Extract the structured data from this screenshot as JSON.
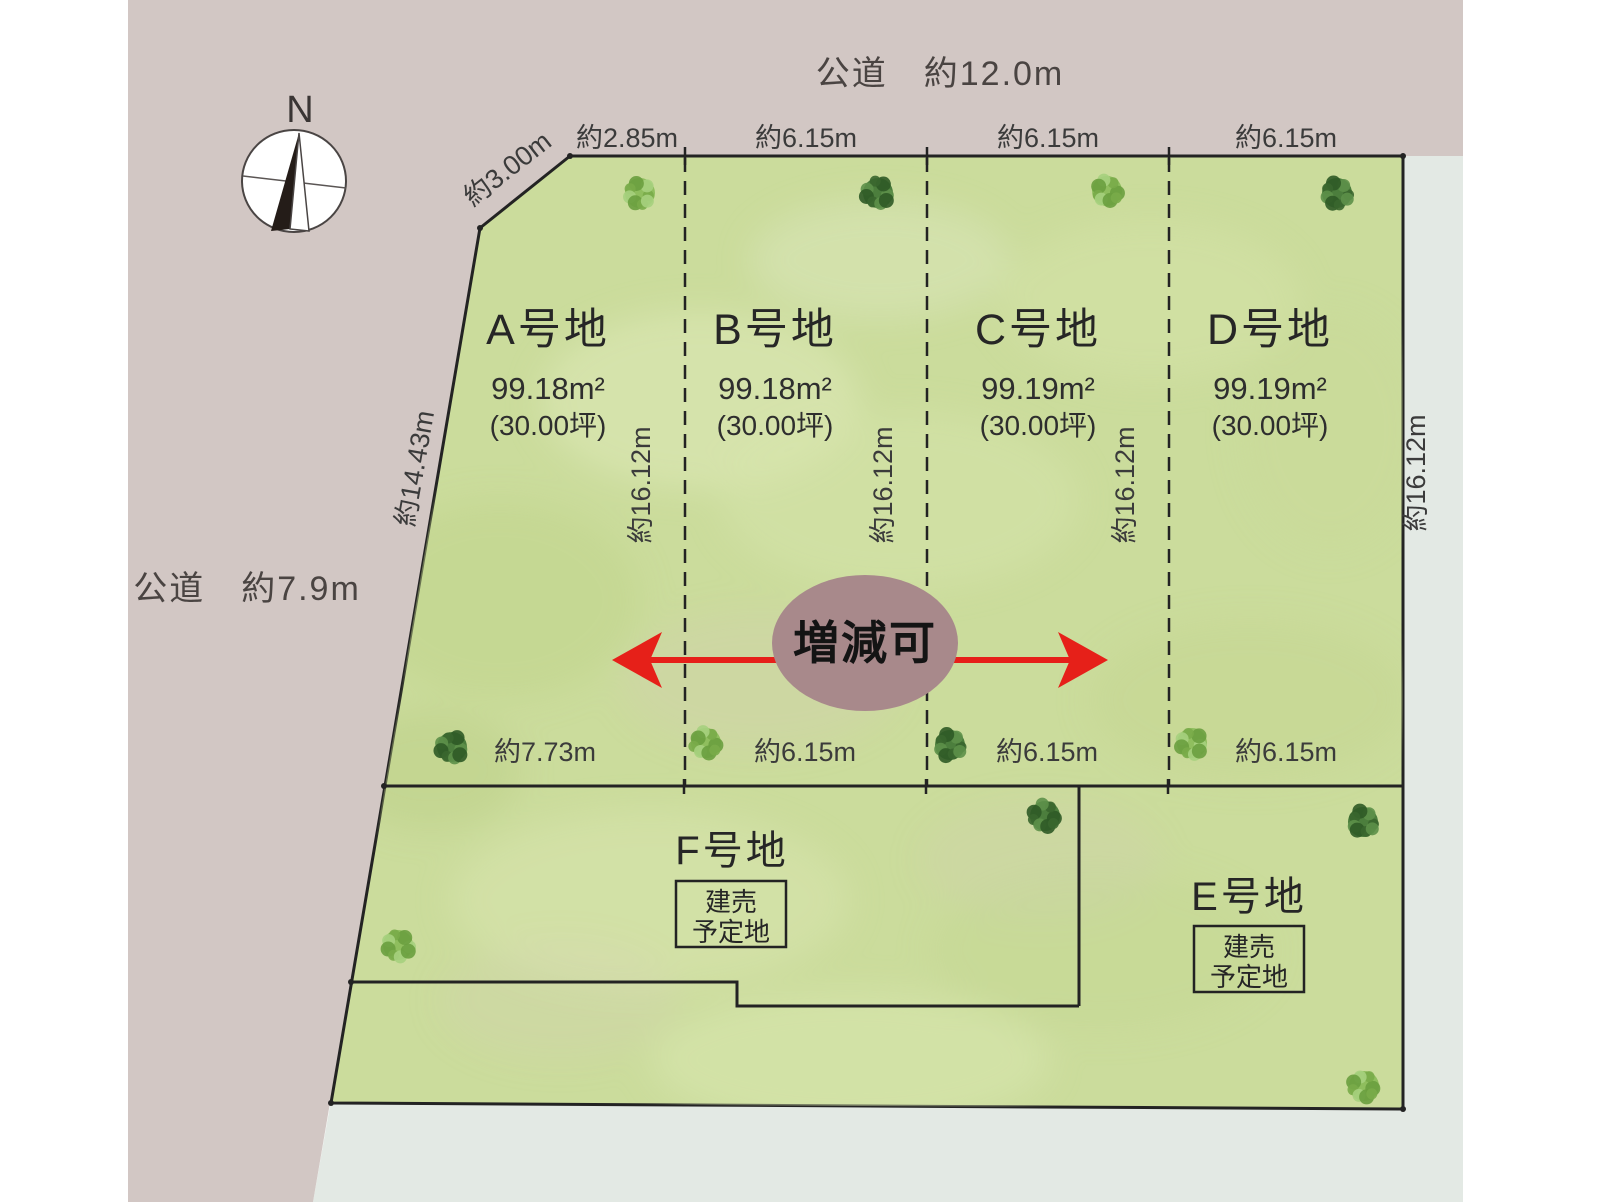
{
  "roads": {
    "top_label": "公道　約12.0m",
    "left_label": "公道　約7.9m"
  },
  "compass": {
    "north_label": "N"
  },
  "plots": {
    "a": {
      "name": "A号地",
      "area": "99.18m²",
      "tsubo": "(30.00坪)"
    },
    "b": {
      "name": "B号地",
      "area": "99.18m²",
      "tsubo": "(30.00坪)"
    },
    "c": {
      "name": "C号地",
      "area": "99.19m²",
      "tsubo": "(30.00坪)"
    },
    "d": {
      "name": "D号地",
      "area": "99.19m²",
      "tsubo": "(30.00坪)"
    },
    "f": {
      "name": "F号地",
      "note_line1": "建売",
      "note_line2": "予定地"
    },
    "e": {
      "name": "E号地",
      "note_line1": "建売",
      "note_line2": "予定地"
    }
  },
  "dimensions": {
    "top_edge": [
      "約2.85m",
      "約6.15m",
      "約6.15m",
      "約6.15m"
    ],
    "bottom_edge": [
      "約7.73m",
      "約6.15m",
      "約6.15m",
      "約6.15m"
    ],
    "diagonal_short": "約3.00m",
    "diagonal_long": "約14.43m",
    "depths": [
      "約16.12m",
      "約16.12m",
      "約16.12m",
      "約16.12m"
    ]
  },
  "annotation": {
    "adjustable_label": "増減可"
  },
  "colors": {
    "road": "#d2c7c4",
    "land": "#cbdc9c",
    "side_road": "#e3e9e4",
    "ellipse": "#a8898b",
    "arrow": "#e62019",
    "line": "#232323"
  },
  "decor": {
    "trees": [
      {
        "x": 640,
        "y": 193,
        "shade": "light"
      },
      {
        "x": 878,
        "y": 193,
        "shade": "dark"
      },
      {
        "x": 1107,
        "y": 191,
        "shade": "light"
      },
      {
        "x": 1337,
        "y": 193,
        "shade": "dark"
      },
      {
        "x": 452,
        "y": 747,
        "shade": "dark"
      },
      {
        "x": 706,
        "y": 743,
        "shade": "light"
      },
      {
        "x": 950,
        "y": 745,
        "shade": "dark"
      },
      {
        "x": 1192,
        "y": 743,
        "shade": "light"
      },
      {
        "x": 1045,
        "y": 816,
        "shade": "dark"
      },
      {
        "x": 1363,
        "y": 822,
        "shade": "dark"
      },
      {
        "x": 398,
        "y": 945,
        "shade": "light"
      },
      {
        "x": 1364,
        "y": 1086,
        "shade": "light"
      }
    ]
  }
}
